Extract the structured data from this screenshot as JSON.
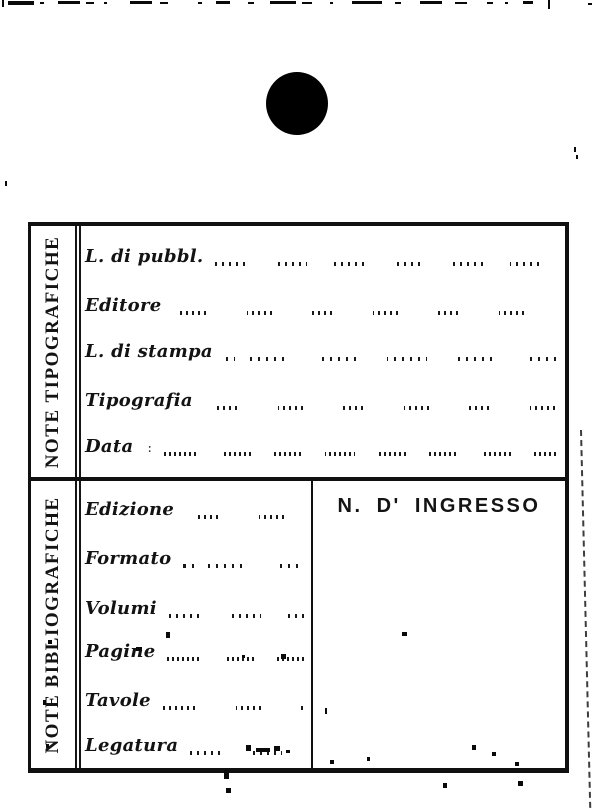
{
  "card": {
    "typographic_section": {
      "side_label": "NOTE TIPOGRAFICHE",
      "fields": [
        {
          "label": "L. di pubbl."
        },
        {
          "label": "Editore"
        },
        {
          "label": "L. di stampa"
        },
        {
          "label": "Tipografia"
        },
        {
          "label": "Data",
          "separator": ":"
        }
      ]
    },
    "bibliographic_section": {
      "side_label": "NOTE BIBLIOGRAFICHE",
      "fields": [
        {
          "label": "Edizione"
        },
        {
          "label": "Formato"
        },
        {
          "label": "Volumi"
        },
        {
          "label": "Pagine"
        },
        {
          "label": "Tavole"
        },
        {
          "label": "Legatura"
        }
      ],
      "ingress_panel": {
        "title": "N. D' INGRESSO"
      }
    }
  },
  "colors": {
    "ink": "#101010",
    "paper": "#ffffff"
  }
}
